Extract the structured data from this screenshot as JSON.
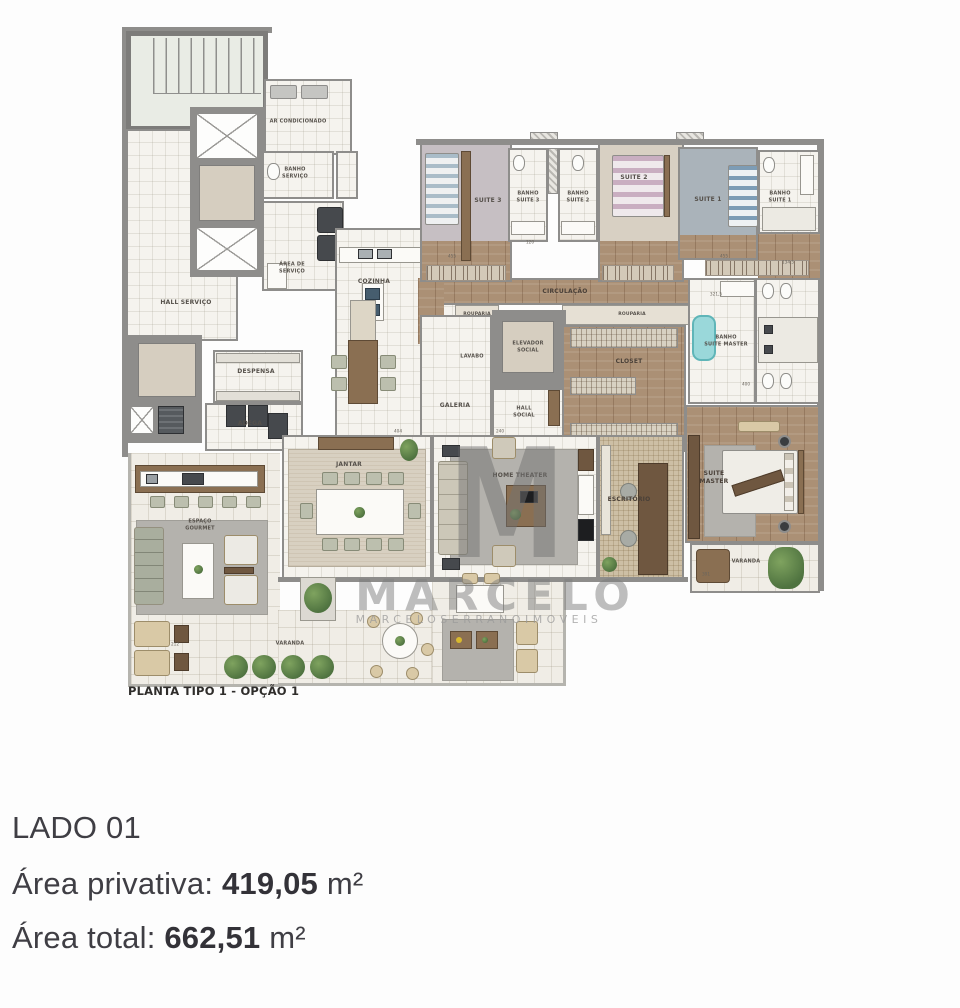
{
  "plan": {
    "caption": "PLANTA TIPO 1 - OPÇÃO 1",
    "rooms": {
      "ar_condicionado": "AR CONDICIONADO",
      "banho_servico": "BANHO\nSERVIÇO",
      "hall_servico": "HALL SERVIÇO",
      "area_servico": "ÁREA DE\nSERVIÇO",
      "cozinha": "COZINHA",
      "despensa": "DESPENSA",
      "adega": "ADEGA",
      "suite3": "SUITE 3",
      "banho_suite3": "BANHO\nSUITE 3",
      "banho_suite2": "BANHO\nSUITE 2",
      "suite2": "SUITE 2",
      "suite1": "SUITE 1",
      "banho_suite1": "BANHO\nSUITE 1",
      "circulacao": "CIRCULAÇÃO",
      "rouparia1": "ROUPARIA",
      "rouparia2": "ROUPARIA",
      "lavabo": "LAVABO",
      "elevador_social": "ELEVADOR\nSOCIAL",
      "closet": "CLOSET",
      "banho_suite_master": "BANHO\nSUITE MASTER",
      "galeria": "GALERIA",
      "hall_social": "HALL\nSOCIAL",
      "jantar": "JANTAR",
      "home_theater": "HOME THEATER",
      "escritorio": "ESCRITÓRIO",
      "suite_master": "SUITE\nMASTER",
      "varanda_master": "VARANDA",
      "espaco_gourmet": "ESPAÇO\nGOURMET",
      "varanda": "VARANDA"
    },
    "dims": [
      {
        "t": "404",
        "x": 278,
        "y": 407
      },
      {
        "t": "240",
        "x": 380,
        "y": 407
      },
      {
        "t": "455",
        "x": 332,
        "y": 232
      },
      {
        "t": "455",
        "x": 604,
        "y": 232
      },
      {
        "t": "120",
        "x": 410,
        "y": 218
      },
      {
        "t": "134,5",
        "x": 668,
        "y": 238
      },
      {
        "t": "321,5",
        "x": 596,
        "y": 270
      },
      {
        "t": "400",
        "x": 626,
        "y": 360
      },
      {
        "t": "391",
        "x": 586,
        "y": 550
      },
      {
        "t": "212",
        "x": 55,
        "y": 620
      }
    ]
  },
  "watermark": {
    "monogram": "M",
    "brand": "MARCELO",
    "brand_sub": "MARCELOSERRANOIMOVEIS"
  },
  "unit_info": {
    "side": "LADO 01",
    "private_area_label": "Área privativa:",
    "private_area_value": "419,05",
    "total_area_label": "Área total:",
    "total_area_value": "662,51",
    "area_unit": "m²"
  },
  "colors": {
    "wall": "#8e8d8b",
    "wood_floor": "#ab9075",
    "bathtub": "#9ad8da",
    "accent_text": "#3f3e44"
  }
}
